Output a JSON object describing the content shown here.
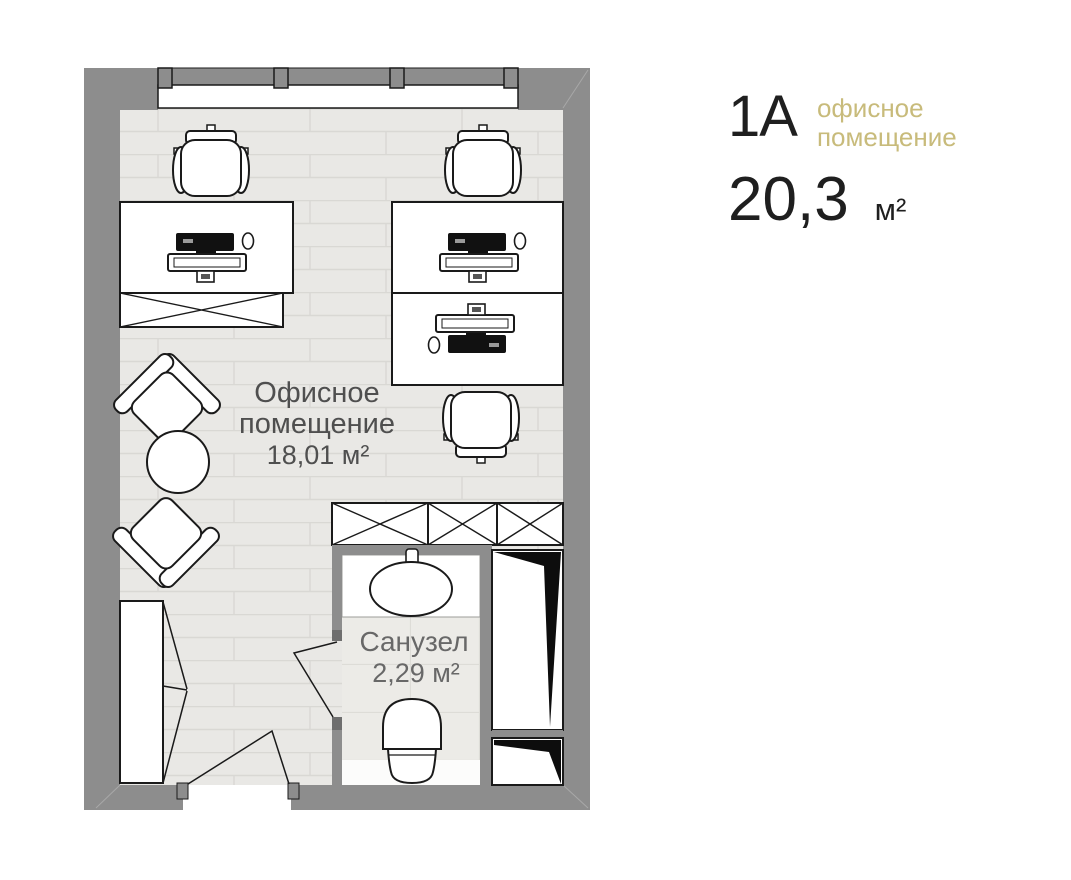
{
  "unit_info": {
    "id": "1А",
    "type_line1": "офисное",
    "type_line2": "помещение",
    "area_value": "20,3",
    "area_unit": "м²"
  },
  "floorplan": {
    "rooms": {
      "office": {
        "name_line1": "Офисное",
        "name_line2": "помещение",
        "area": "18,01 м²"
      },
      "bathroom": {
        "name": "Санузел",
        "area": "2,29 м²"
      }
    },
    "furniture_icons": [
      "desk-workstation-icon",
      "office-chair-icon",
      "lounge-armchair-icon",
      "round-coffee-table-icon",
      "x-storage-cabinet-icon",
      "wardrobe-icon",
      "tall-cabinet-icon",
      "bathroom-sink-icon",
      "toilet-icon",
      "window-icon",
      "door-swing-icon"
    ],
    "colors": {
      "wall": "#8d8d8d",
      "floor": "#e9e8e5",
      "outline": "#1a1a1a",
      "accent_gold": "#c8bb7b"
    }
  }
}
